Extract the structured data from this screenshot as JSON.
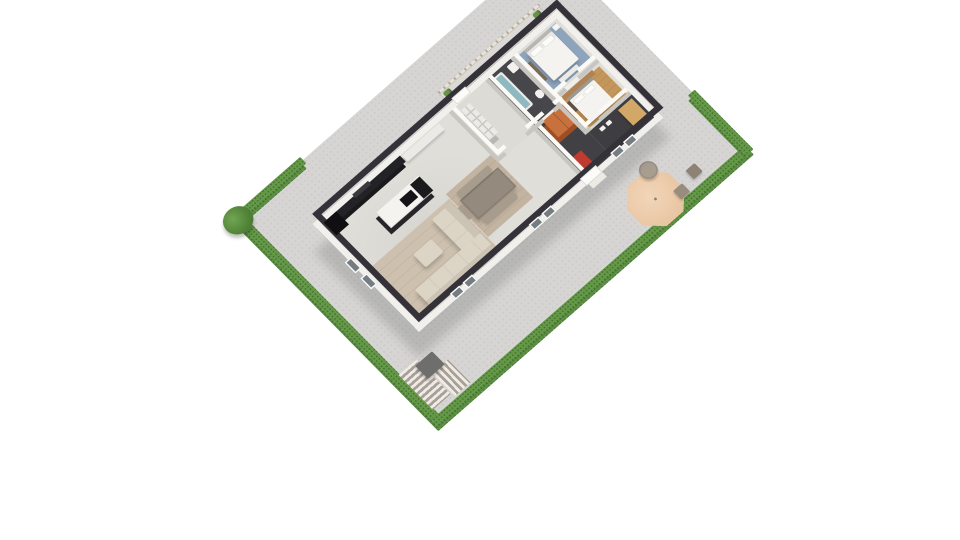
{
  "scene": {
    "type": "3d-floor-plan-render",
    "view": "isometric-birds-eye",
    "background": "white",
    "description": "Single-storey house with open kitchen-living-dining area, two bedrooms, bathroom and dark hallway, surrounded by a paved yard bordered by green hedges, with patio furniture, parasol, deck stairs and a rear balcony terrace"
  },
  "palette": {
    "page_bg": "#ffffff",
    "paving": "#d6d5d3",
    "hedge": "#5a8f41",
    "hedge_top": "#649a47",
    "bush": "#4b7d33",
    "bush_light": "#71a452",
    "deck_light": "#efece5",
    "deck_dark": "#a8a098",
    "mat_gray": "#6e6e6c",
    "parasol": "#e8c5a2",
    "parasol_light": "#f2d6b8",
    "patio_table": "#a89e90",
    "stool": "#8d8274",
    "stool2": "#978c7e",
    "balcony": "#dbdad6",
    "railing": "#b4ab9b",
    "plant": "#679247",
    "slab": "#f0efeb",
    "slab_edge": "#39373a",
    "concrete": "#dfded9",
    "concrete2": "#dcdbd6",
    "floor_dark": "#47474b",
    "floor_dark2": "#414145",
    "floor_dark3": "#3e3e42",
    "wood_living": "#cdc0af",
    "wood_dining": "#c3b3a1",
    "rug_blue": "#8da4bc",
    "rug_tan": "#c3965c",
    "kitchen_black": "#1a1a1d",
    "kitchen_black2": "#232327",
    "island_top": "#f4f3ef",
    "white_furn": "#eceae6",
    "sofa": "#dcd5c6",
    "sofa_dark": "#cbc4b4",
    "table_wood": "#948a7d",
    "bench_wood": "#a79d8f",
    "bed_white": "#f4f3f0",
    "headboard": "#b9b6b1",
    "dresser": "#7a6a58",
    "sideboard": "#b08355",
    "tub_teal": "#8fb9c1",
    "orange": "#c8713d",
    "orange_dark": "#9c4f24",
    "mat_red": "#bf3a31",
    "bench_tan": "#d2a767",
    "wall_int_base": "#c8c6c1",
    "wall_int_cap": "#fbfaf7",
    "wall_ext_face": "#f1f0ec",
    "wall_ext_cap": "#343238",
    "window_pane": "#767d82"
  },
  "yard": {
    "hedges": [
      "north-west",
      "south-west",
      "south-east",
      "north-east"
    ],
    "items": [
      "shrub",
      "deck-stairs-a",
      "deck-stairs-b",
      "utility-mat",
      "patio-parasol",
      "patio-table",
      "patio-stool",
      "patio-stool",
      "balcony-terrace",
      "balcony-railing",
      "balcony-plant",
      "balcony-plant"
    ]
  },
  "house": {
    "rooms": [
      {
        "name": "kitchen-living-dining",
        "floor": "concrete",
        "furniture": [
          "kitchen-counter",
          "tall-cabinet",
          "cooktop",
          "kitchen-island",
          "wall-bench",
          "area-rug-wood",
          "l-sofa",
          "ottoman",
          "dining-rug",
          "dining-table",
          "dining-bench",
          "dining-chair",
          "cubby-shelf"
        ]
      },
      {
        "name": "entry-hall",
        "floor": "concrete",
        "furniture": [
          "back-door"
        ]
      },
      {
        "name": "bathroom",
        "floor": "dark-tile",
        "furniture": [
          "bathtub",
          "sink",
          "toilet"
        ]
      },
      {
        "name": "bedroom-blue",
        "floor": "concrete",
        "furniture": [
          "blue-rug",
          "double-bed",
          "pillows",
          "foot-bench",
          "dresser",
          "nightstand"
        ]
      },
      {
        "name": "bedroom-tan",
        "floor": "concrete",
        "furniture": [
          "tan-rug",
          "double-bed",
          "pillows",
          "sideboard",
          "dark-unit"
        ]
      },
      {
        "name": "hallway-dark",
        "floor": "dark-tile",
        "furniture": [
          "orange-wardrobe",
          "red-doormat",
          "floor-fixtures",
          "tan-bench",
          "front-door",
          "door-step"
        ]
      }
    ]
  }
}
